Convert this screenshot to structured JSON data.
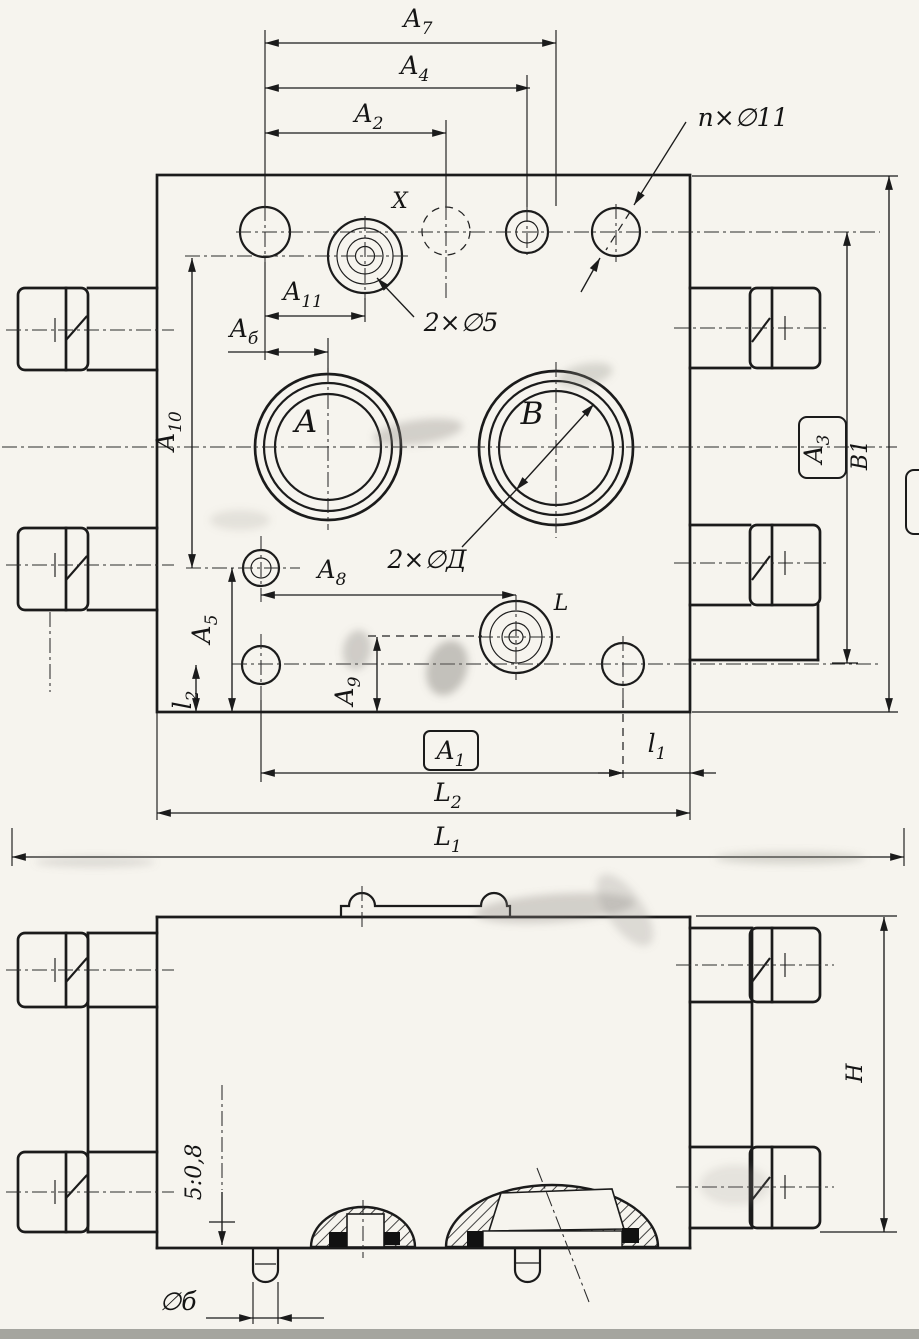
{
  "top_view": {
    "dims": {
      "a7": {
        "main": "A",
        "sub": "7"
      },
      "a4": {
        "main": "A",
        "sub": "4"
      },
      "a2": {
        "main": "A",
        "sub": "2"
      },
      "a11": {
        "main": "A",
        "sub": "11"
      },
      "a6": {
        "main": "A",
        "sub": "б"
      },
      "a10": {
        "main": "A",
        "sub": "10"
      },
      "a8": {
        "main": "A",
        "sub": "8"
      },
      "a5": {
        "main": "A",
        "sub": "5"
      },
      "a9": {
        "main": "A",
        "sub": "9"
      },
      "l2": {
        "main": "l",
        "sub": "2"
      },
      "a1": {
        "main": "A",
        "sub": "1"
      },
      "l1": {
        "main": "l",
        "sub": "1"
      },
      "L2": {
        "main": "L",
        "sub": "2"
      },
      "L1": {
        "main": "L",
        "sub": "1"
      },
      "a3": {
        "main": "A",
        "sub": "3"
      },
      "b1": "B1"
    },
    "ports": {
      "a": "A",
      "b": "B",
      "l": "L",
      "x": "X"
    },
    "callouts": {
      "mount_holes": "п×∅11",
      "pilot_holes": "2×∅5",
      "main_ports": "2×∅Д"
    }
  },
  "bottom_view": {
    "dims": {
      "height": "H",
      "step": "5:0,8",
      "stud_dia": "∅б"
    }
  },
  "colors": {
    "ink": "#1b1b1b",
    "paper": "#f6f4ee"
  }
}
